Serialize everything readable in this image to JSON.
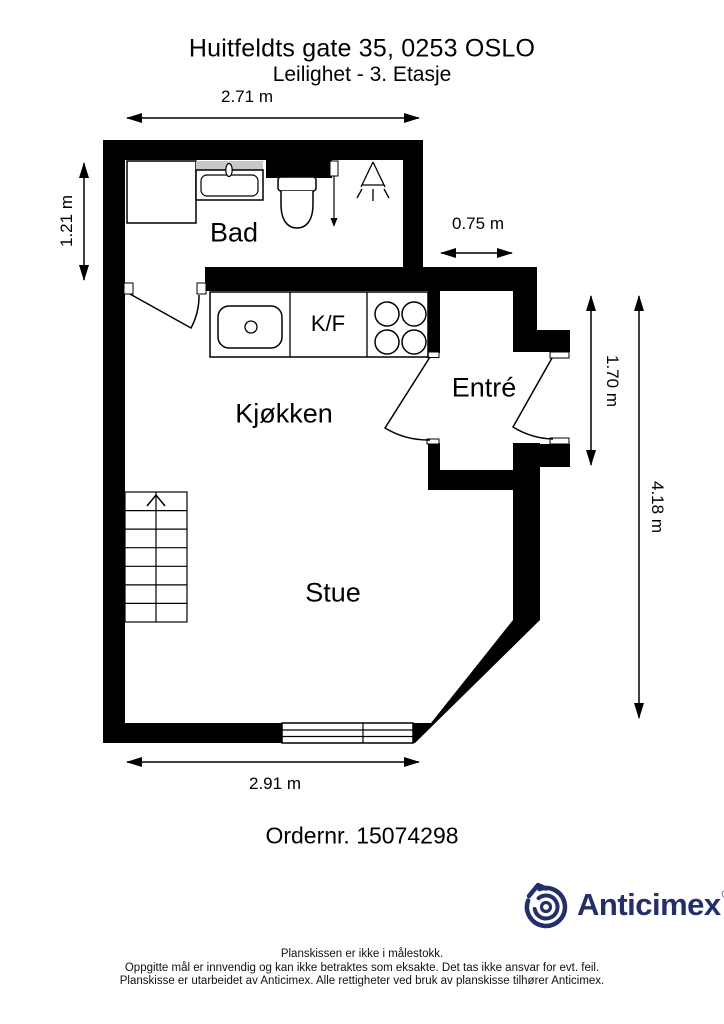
{
  "header": {
    "title": "Huitfeldts gate 35, 0253 OSLO",
    "subtitle": "Leilighet - 3. Etasje"
  },
  "rooms": {
    "bathroom": "Bad",
    "kitchen": "Kjøkken",
    "living_room": "Stue",
    "entrance": "Entré",
    "fridge_freezer": "K/F"
  },
  "dimensions": {
    "bathroom_width": "2.71 m",
    "bathroom_depth": "1.21 m",
    "entrance_width": "0.75 m",
    "entrance_depth": "1.70 m",
    "right_total_height": "4.18 m",
    "living_room_width": "2.91 m"
  },
  "order_number": "Ordernr. 15074298",
  "branding": {
    "company": "Anticimex",
    "registered": "®",
    "logo_color": "#232e6a"
  },
  "colors": {
    "wall": "#000000",
    "sink_counter_gray": "#c8c8c8"
  },
  "footer": {
    "line1": "Planskissen er ikke i målestokk.",
    "line2": "Oppgitte mål er innvendig og kan ikke betraktes som eksakte. Det tas ikke ansvar for evt. feil.",
    "line3": "Planskisse er utarbeidet av Anticimex. Alle rettigheter ved bruk av planskisse tilhører Anticimex."
  }
}
